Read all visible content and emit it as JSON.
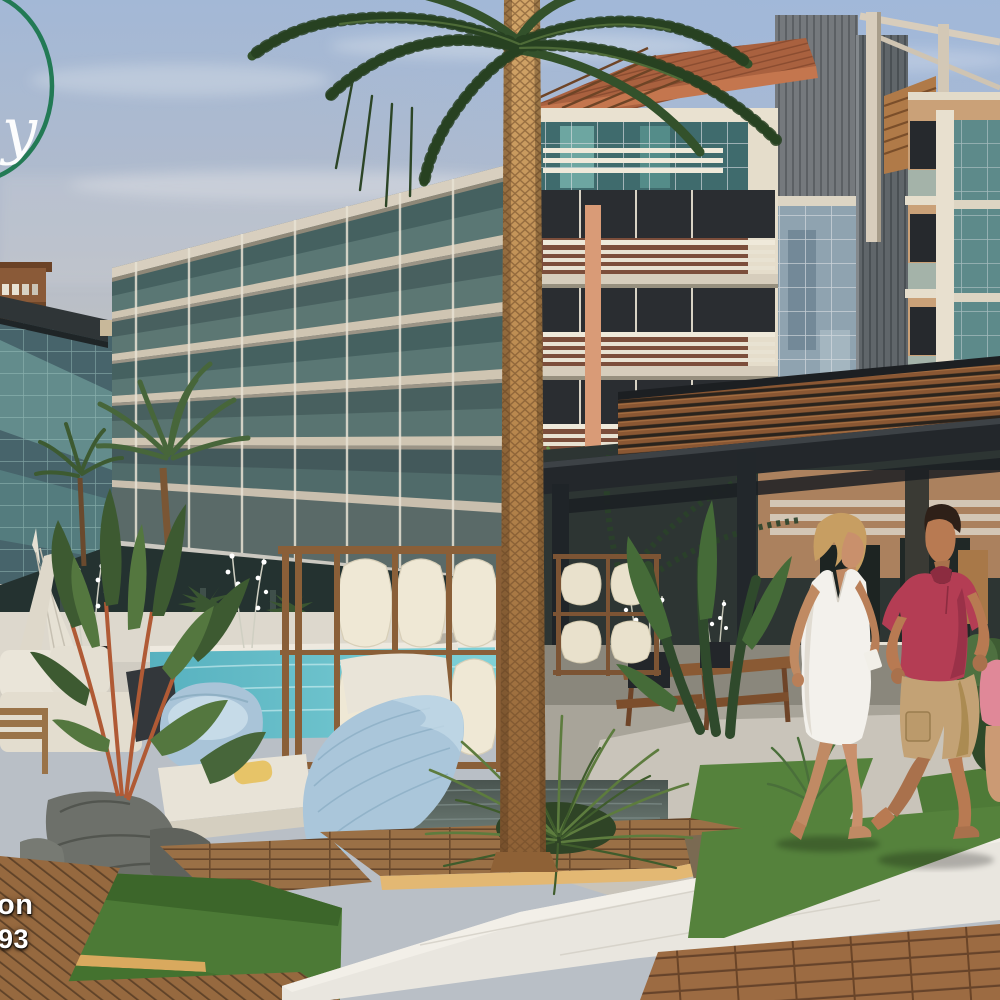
{
  "image": {
    "title": "Seaside resort apartment complex — 3D architectural rendering",
    "description": "Modern multi-storey apartment buildings with glass balconies around a turquoise pool, palm trees, pergola lounge, outdoor furniture, and a couple walking barefoot on a path"
  },
  "watermark": {
    "letter": "y",
    "note": "partial circular logo cut off at top-left edge"
  },
  "captions": {
    "fragment_top": "on",
    "fragment_bottom": "93",
    "note": "white bold text fragments cut off at the bottom-left image edge"
  },
  "palette": {
    "logo_green": "#17744a",
    "caption_white": "#ffffff",
    "sky_blue": "#a3b8d6",
    "haze": "#d2cdc2",
    "glass_teal": "#4e7472",
    "glass_blue": "#8fa3b0",
    "facade_cream": "#e9e1d0",
    "terracotta_roof": "#a9613f",
    "wood_tan": "#b07a48",
    "corrugated_gray": "#65696d",
    "pergola_steel": "#23272b",
    "pergola_wood": "#8a5733",
    "pool_water": "#7ccfd6",
    "pool_bright": "#a5e0e4",
    "deck_wood": "#9a7046",
    "deck_lit_edge": "#e3b873",
    "concrete_path": "#e9e6df",
    "grass_green": "#4c7a36",
    "leaf_dark": "#31502e",
    "rock_gray": "#6d706a",
    "furniture_blue": "#aac6da",
    "cushion_cream": "#e9e4d8",
    "palm_trunk_gold": "#c39a5e",
    "skin_tone": "#c08a64",
    "hair_blonde": "#c79e62",
    "dress_white": "#f3f1ec",
    "polo_crimson": "#b43d54",
    "shorts_khaki": "#c3a275",
    "child_pink": "#e08898"
  },
  "scene": {
    "buildings": [
      "left orange low-rise block",
      "left teal glass tower with dark roof canopy",
      "long west wing with stepped glass balconies",
      "center building with terracotta roof, white bar railings and brown brick",
      "right tower with corrugated gray siding and rooftop timber frame"
    ],
    "amenities": [
      "turquoise swimming pool with loungers",
      "steel pergola with timber slats",
      "wooden screens with stretched canvas panels",
      "blue lounge chairs and cream daybeds",
      "closed patio umbrellas",
      "white orchid planters",
      "central tall palm tree and tropical landscaping"
    ],
    "people": [
      "blonde woman in white sleeveless dress walking barefoot",
      "man in crimson polo shirt and khaki cargo shorts walking barefoot",
      "partially visible child in pink at right edge"
    ]
  }
}
